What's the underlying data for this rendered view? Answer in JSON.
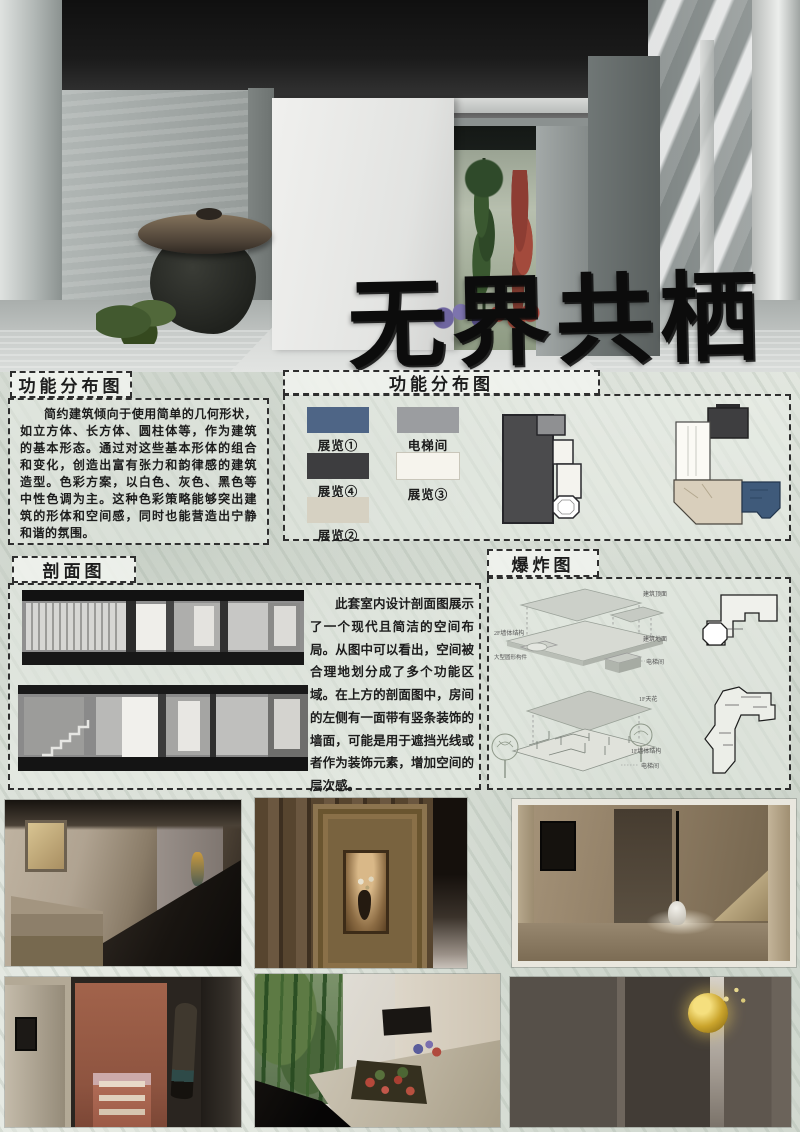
{
  "poster": {
    "title": "无界共栖",
    "function_box": {
      "title": "功能分布图",
      "body": "简约建筑倾向于使用简单的几何形状，如立方体、长方体、圆柱体等，作为建筑的基本形态。通过对这些基本形体的组合和变化，创造出富有张力和韵律感的建筑造型。色彩方案，以白色、灰色、黑色等中性色调为主。这种色彩策略能够突出建筑的形体和空间感，同时也能营造出宁静和谐的氛围。"
    },
    "legend": {
      "title": "功能分布图",
      "items": [
        {
          "label": "展览①",
          "color": "#4e6586"
        },
        {
          "label": "展览④",
          "color": "#3d3d3f"
        },
        {
          "label": "展览②",
          "color": "#d6d1c2"
        },
        {
          "label": "电梯间",
          "color": "#9b9da0"
        },
        {
          "label": "展览③",
          "color": "#f6f4ed"
        }
      ]
    },
    "section_box": {
      "title": "剖面图",
      "body": "此套室内设计剖面图展示了一个现代且简洁的空间布局。从图中可以看出，空间被合理地划分成了多个功能区域。在上方的剖面图中，房间的左侧有一面带有竖条装饰的墙面，可能是用于遮挡光线或者作为装饰元素，增加空间的层次感。"
    },
    "exploded_box": {
      "title": "爆炸图",
      "labels_upper": [
        "建筑顶面",
        "2F墙体结构",
        "大型圆形构件",
        "建筑地面",
        "电梯间"
      ],
      "labels_lower": [
        "1F天花",
        "1F墙体结构",
        "电梯间"
      ]
    }
  }
}
